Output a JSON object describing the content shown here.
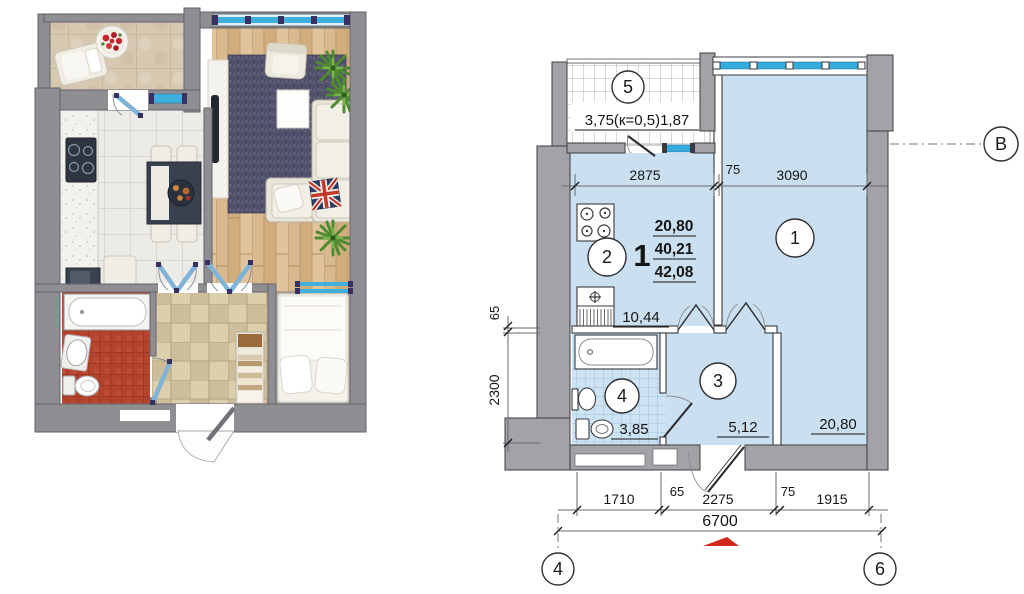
{
  "colors": {
    "tech_wall_gray": "#a3a3a7",
    "render_wall_gray": "#8e8e93",
    "floor_blue": "#cadff0",
    "window_blue": "#35aadb",
    "door_blue": "#7fb3d8",
    "arrow_red": "#d3281c",
    "bath_tile_red": "#b4432e",
    "wood_tan": "#d9b98e"
  },
  "technical_plan": {
    "room_circles": [
      "1",
      "2",
      "3",
      "4",
      "5"
    ],
    "area_labels": {
      "room1": "20,80",
      "kitchen": "10,44",
      "hall": "5,12",
      "bath": "3,85"
    },
    "balcony_label": "3,75(к=0,5)1,87",
    "apartment_stamp": {
      "number": "1",
      "values": [
        "20,80",
        "40,21",
        "42,08"
      ]
    },
    "dimensions": {
      "top": [
        "2875",
        "75",
        "3090"
      ],
      "left": [
        "65",
        "2300"
      ],
      "bottom": [
        "1710",
        "65",
        "2275",
        "75",
        "1915"
      ],
      "overall": "6700"
    },
    "grid_markers": {
      "right": "В",
      "bottom_left": "4",
      "bottom_right": "6"
    }
  },
  "render_plan": {
    "furniture": [
      "lounge-chair",
      "flower-plate",
      "cooktop",
      "kitchen-sink",
      "counter",
      "stool",
      "dining-table",
      "dining-chairs",
      "tv-panel",
      "area-rug",
      "armchair",
      "coffee-table",
      "corner-sofa",
      "union-jack-pillow",
      "potted-plant",
      "double-bed",
      "pillows",
      "linen-shelf",
      "bathtub",
      "washbasin",
      "toilet",
      "entrance-door"
    ]
  }
}
